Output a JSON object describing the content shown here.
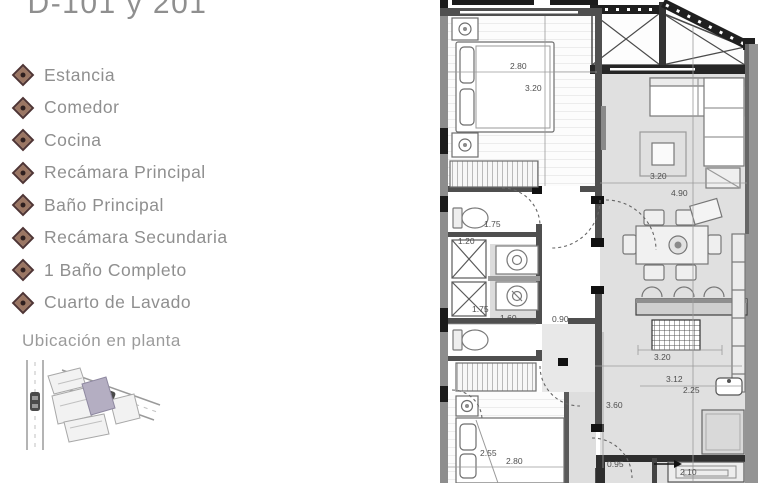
{
  "panel": {
    "title": "D-101 y 201",
    "legend": [
      "Estancia",
      "Comedor",
      "Cocina",
      "Recámara Principal",
      "Baño Principal",
      "Recámara Secundaria",
      "1 Baño Completo",
      "Cuarto de Lavado"
    ],
    "location_label": "Ubicación en planta",
    "colors": {
      "bullet_accent": "#4e3434",
      "text_gray": "#8f8f8f",
      "site_highlight": "#b4aec2"
    }
  },
  "plan": {
    "colors": {
      "floor_gray": "#e0e0e0",
      "wall_dark": "#4f4f4f",
      "wall_light": "#8d8d8d"
    },
    "dims": {
      "master_w": "2.80",
      "master_d": "3.20",
      "living_w": "3.20",
      "living_d": "4.90",
      "bath1_a": "1.75",
      "bath1_b": "1.20",
      "laundry_a": "1.75",
      "laundry_b": "1.60",
      "hall_w": "0.90",
      "kitchen_a": "3.20",
      "kitchen_b": "3.12",
      "kitchen_c": "2.25",
      "kitchen_d": "3.60",
      "entry_a": "0.95",
      "entry_b": "2.10",
      "bed2_a": "2.55",
      "bed2_b": "2.80"
    }
  }
}
